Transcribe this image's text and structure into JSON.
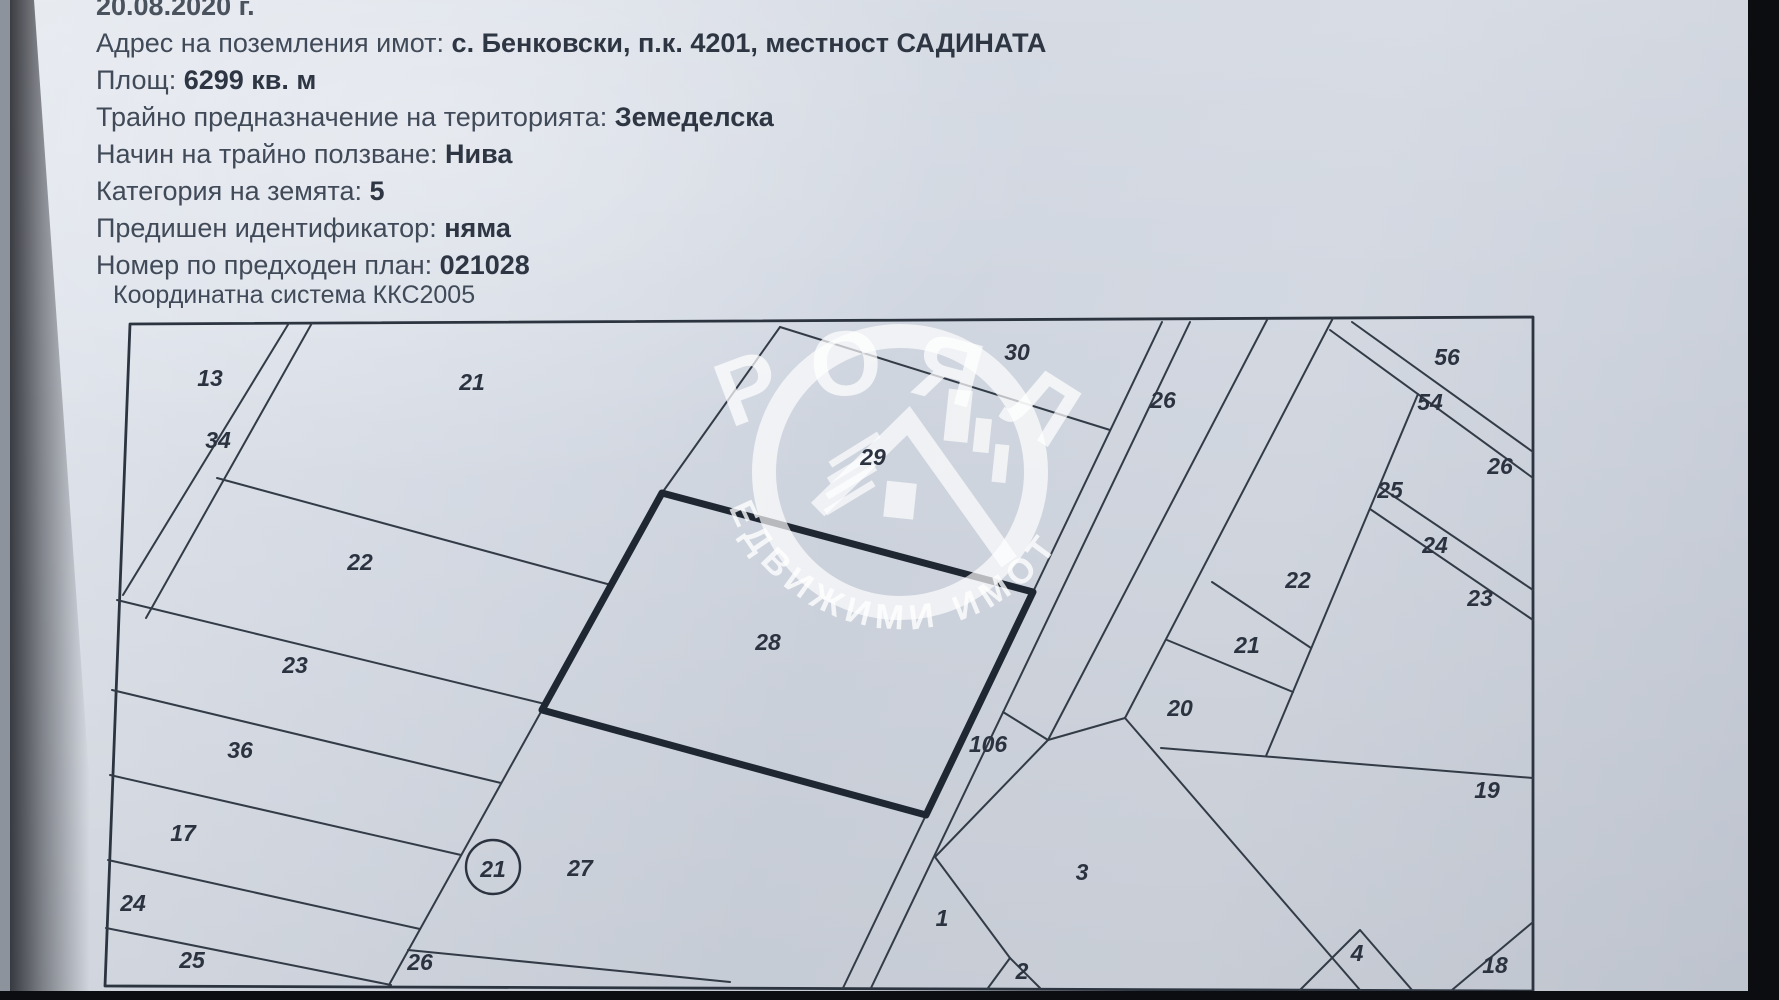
{
  "document": {
    "date_line": "20.08.2020 г.",
    "info_lines": [
      {
        "label": "Адрес на поземления имот:",
        "value": "с. Бенковски, п.к. 4201, местност САДИНАТА"
      },
      {
        "label": "Площ:",
        "value": "6299 кв. м"
      },
      {
        "label": "Трайно предназначение на територията:",
        "value": "Земеделска"
      },
      {
        "label": "Начин на трайно ползване:",
        "value": "Нива"
      },
      {
        "label": "Категория на земята:",
        "value": "5"
      },
      {
        "label": "Предишен идентификатор:",
        "value": "няма"
      },
      {
        "label": "Номер по предходен план:",
        "value": "021028"
      }
    ],
    "coordinate_system": "Координатна система ККС2005"
  },
  "watermark": {
    "brand_top": "РОЯЛ",
    "brand_bottom": "НЕДВИЖИМИ ИМОТИ"
  },
  "map": {
    "parcel_labels": [
      {
        "id": "13",
        "x": 210,
        "y": 378
      },
      {
        "id": "21",
        "x": 472,
        "y": 382
      },
      {
        "id": "34",
        "x": 218,
        "y": 440
      },
      {
        "id": "22",
        "x": 360,
        "y": 562
      },
      {
        "id": "23",
        "x": 295,
        "y": 665
      },
      {
        "id": "36",
        "x": 240,
        "y": 750
      },
      {
        "id": "17",
        "x": 183,
        "y": 833
      },
      {
        "id": "24",
        "x": 133,
        "y": 903
      },
      {
        "id": "25",
        "x": 192,
        "y": 960
      },
      {
        "id": "26",
        "x": 420,
        "y": 962
      },
      {
        "id": "27",
        "x": 580,
        "y": 868
      },
      {
        "id": "28",
        "x": 768,
        "y": 642
      },
      {
        "id": "29",
        "x": 873,
        "y": 457,
        "size": 22
      },
      {
        "id": "30",
        "x": 1017,
        "y": 352
      },
      {
        "id": "106",
        "x": 988,
        "y": 744,
        "size": 22
      },
      {
        "id": "26",
        "x": 1163,
        "y": 400
      },
      {
        "id": "1",
        "x": 942,
        "y": 918,
        "size": 21
      },
      {
        "id": "2",
        "x": 1022,
        "y": 971,
        "size": 20
      },
      {
        "id": "3",
        "x": 1082,
        "y": 872,
        "size": 22
      },
      {
        "id": "56",
        "x": 1447,
        "y": 357
      },
      {
        "id": "54",
        "x": 1430,
        "y": 402,
        "size": 22
      },
      {
        "id": "26",
        "x": 1500,
        "y": 466,
        "size": 22
      },
      {
        "id": "25",
        "x": 1390,
        "y": 490,
        "size": 22
      },
      {
        "id": "24",
        "x": 1435,
        "y": 545,
        "size": 22
      },
      {
        "id": "23",
        "x": 1480,
        "y": 598,
        "size": 22
      },
      {
        "id": "22",
        "x": 1298,
        "y": 580
      },
      {
        "id": "21",
        "x": 1247,
        "y": 645
      },
      {
        "id": "20",
        "x": 1180,
        "y": 708
      },
      {
        "id": "19",
        "x": 1487,
        "y": 790
      },
      {
        "id": "4",
        "x": 1357,
        "y": 953,
        "size": 20
      },
      {
        "id": "18",
        "x": 1495,
        "y": 965,
        "size": 22
      }
    ],
    "circled_label": {
      "id": "21",
      "x": 493,
      "y": 867,
      "r": 27
    }
  },
  "colors": {
    "paper": "#d3d8e2",
    "map_line": "#333b47",
    "subject_parcel_line": "#1f2733",
    "text": "#414a58",
    "watermark": "#ffffff",
    "photo_background": "#0b0d11"
  }
}
